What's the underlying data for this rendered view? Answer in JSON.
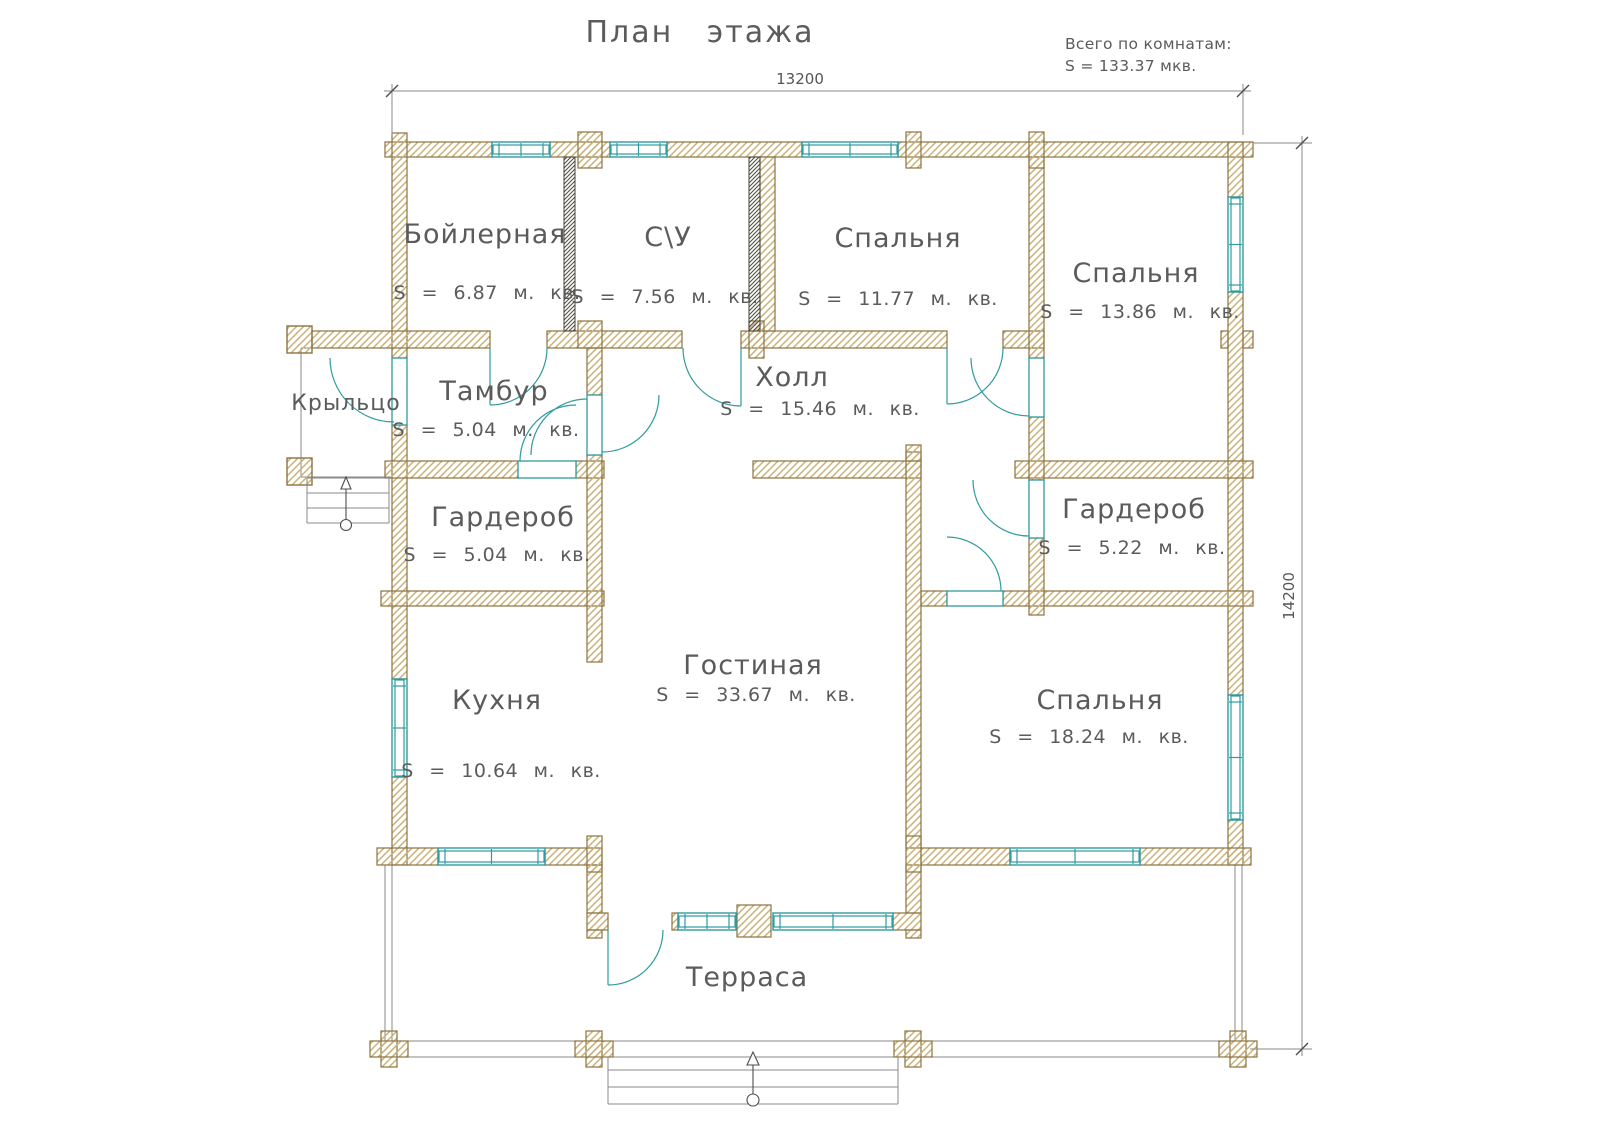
{
  "title": "План этажа",
  "summary": {
    "heading": "Всего по комнатам:",
    "total": "S = 133.37 мкв."
  },
  "dimensions": {
    "width": "13200",
    "height": "14200"
  },
  "rooms": {
    "boilernaya": {
      "name": "Бойлерная",
      "area": "S = 6.87 м. кв."
    },
    "su": {
      "name": "С\\У",
      "area": "S = 7.56 м. кв."
    },
    "bedroom1": {
      "name": "Спальня",
      "area": "S = 11.77 м. кв."
    },
    "bedroom2": {
      "name": "Спальня",
      "area": "S = 13.86 м. кв."
    },
    "porch": {
      "name": "Крыльцо"
    },
    "tambur": {
      "name": "Тамбур",
      "area": "S = 5.04 м. кв."
    },
    "hall": {
      "name": "Холл",
      "area": "S = 15.46 м. кв."
    },
    "wardrobe1": {
      "name": "Гардероб",
      "area": "S = 5.04 м. кв."
    },
    "wardrobe2": {
      "name": "Гардероб",
      "area": "S = 5.22 м. кв."
    },
    "kitchen": {
      "name": "Кухня",
      "area": "S = 10.64 м. кв."
    },
    "living": {
      "name": "Гостиная",
      "area": "S = 33.67 м. кв."
    },
    "bedroom3": {
      "name": "Спальня",
      "area": "S = 18.24 м. кв."
    },
    "terrace": {
      "name": "Терраса"
    }
  },
  "colors": {
    "wall_hatch": "#c9b178",
    "wall_outline": "#8d7340",
    "partition_hatch": "#57503f",
    "fixture_teal": "#2f9b9e",
    "text": "#5b5b5b",
    "dim_line": "#8a8a8a"
  }
}
